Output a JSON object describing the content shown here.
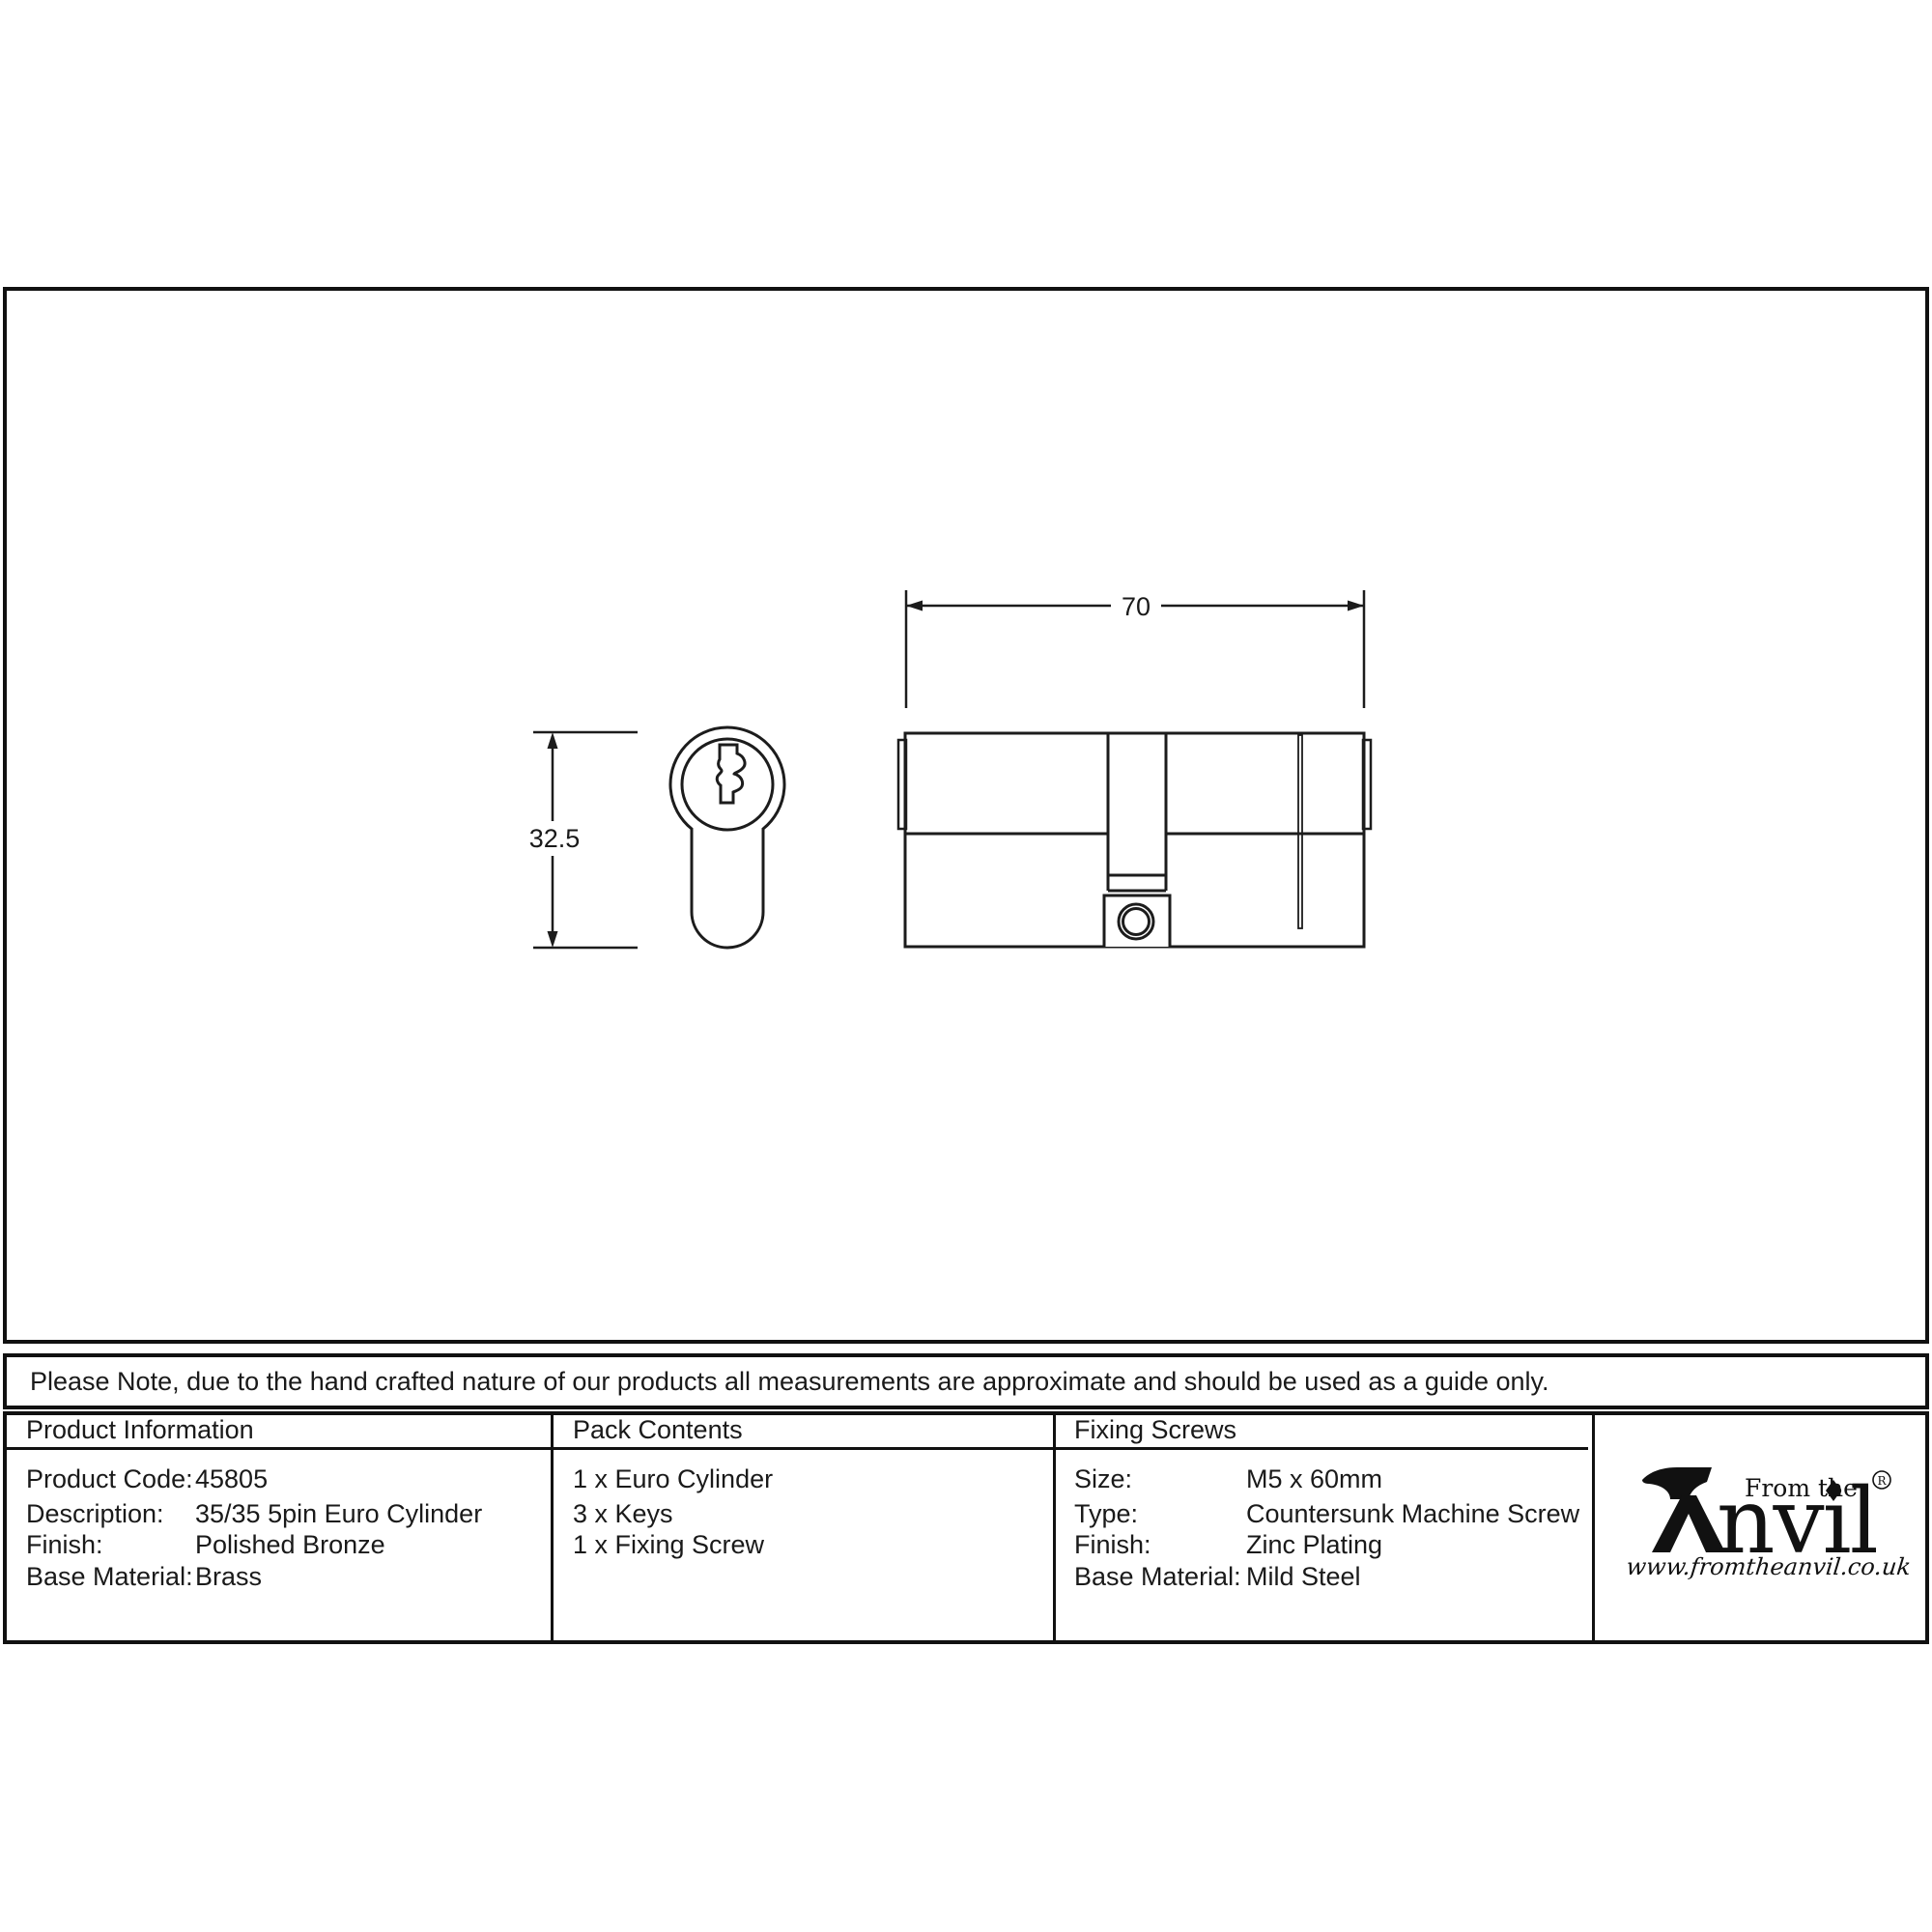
{
  "drawing": {
    "width_dim": "70",
    "height_dim": "32.5"
  },
  "note": "Please Note, due to the hand crafted nature of our products all measurements are approximate and should be used as a guide only.",
  "table": {
    "product_information": {
      "header": "Product Information",
      "rows": [
        {
          "label": "Product Code:",
          "value": "45805"
        },
        {
          "label": "Description:",
          "value": "35/35 5pin Euro Cylinder"
        },
        {
          "label": "Finish:",
          "value": "Polished Bronze"
        },
        {
          "label": "Base Material:",
          "value": "Brass"
        }
      ]
    },
    "pack_contents": {
      "header": "Pack Contents",
      "items": [
        "1 x Euro Cylinder",
        "3 x Keys",
        "1 x Fixing Screw"
      ]
    },
    "fixing_screws": {
      "header": "Fixing Screws",
      "rows": [
        {
          "label": "Size:",
          "value": "M5 x 60mm"
        },
        {
          "label": "Type:",
          "value": "Countersunk Machine Screw"
        },
        {
          "label": "Finish:",
          "value": "Zinc Plating"
        },
        {
          "label": "Base Material:",
          "value": "Mild Steel"
        }
      ]
    }
  },
  "logo": {
    "name": "Anvil",
    "name_rest": "nvil",
    "tagline": "From the",
    "registered": "R",
    "url": "www.fromtheanvil.co.uk"
  }
}
